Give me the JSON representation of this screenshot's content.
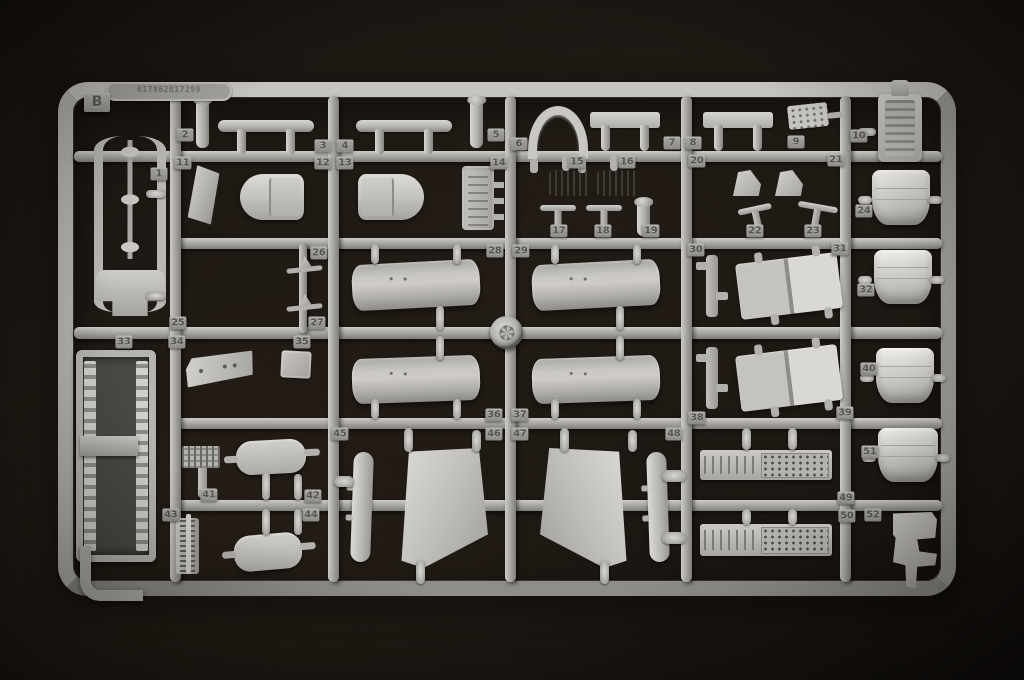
{
  "photo": {
    "subject": "grey injection-molded model kit sprue on black background",
    "background_color": "#1a1511",
    "plastic_color": "#aba9a5",
    "sprue_letter": "B",
    "mold_text": "817862B17299",
    "part_numbers": [
      {
        "n": 1,
        "x": 159,
        "y": 174
      },
      {
        "n": 2,
        "x": 185,
        "y": 135
      },
      {
        "n": 3,
        "x": 323,
        "y": 146
      },
      {
        "n": 4,
        "x": 345,
        "y": 146
      },
      {
        "n": 5,
        "x": 496,
        "y": 135
      },
      {
        "n": 6,
        "x": 519,
        "y": 144
      },
      {
        "n": 7,
        "x": 672,
        "y": 143
      },
      {
        "n": 8,
        "x": 693,
        "y": 143
      },
      {
        "n": 9,
        "x": 796,
        "y": 142
      },
      {
        "n": 10,
        "x": 859,
        "y": 136
      },
      {
        "n": 11,
        "x": 183,
        "y": 163
      },
      {
        "n": 12,
        "x": 323,
        "y": 163
      },
      {
        "n": 13,
        "x": 345,
        "y": 163
      },
      {
        "n": 14,
        "x": 499,
        "y": 163
      },
      {
        "n": 15,
        "x": 577,
        "y": 162
      },
      {
        "n": 16,
        "x": 627,
        "y": 162
      },
      {
        "n": 17,
        "x": 559,
        "y": 231
      },
      {
        "n": 18,
        "x": 603,
        "y": 231
      },
      {
        "n": 19,
        "x": 651,
        "y": 231
      },
      {
        "n": 20,
        "x": 697,
        "y": 161
      },
      {
        "n": 21,
        "x": 836,
        "y": 160
      },
      {
        "n": 22,
        "x": 755,
        "y": 231
      },
      {
        "n": 23,
        "x": 813,
        "y": 231
      },
      {
        "n": 24,
        "x": 864,
        "y": 211
      },
      {
        "n": 25,
        "x": 178,
        "y": 323
      },
      {
        "n": 26,
        "x": 319,
        "y": 253
      },
      {
        "n": 27,
        "x": 317,
        "y": 323
      },
      {
        "n": 28,
        "x": 495,
        "y": 251
      },
      {
        "n": 29,
        "x": 521,
        "y": 251
      },
      {
        "n": 30,
        "x": 696,
        "y": 250
      },
      {
        "n": 31,
        "x": 840,
        "y": 249
      },
      {
        "n": 32,
        "x": 866,
        "y": 290
      },
      {
        "n": 33,
        "x": 124,
        "y": 342
      },
      {
        "n": 34,
        "x": 177,
        "y": 342
      },
      {
        "n": 35,
        "x": 302,
        "y": 342
      },
      {
        "n": 36,
        "x": 494,
        "y": 415
      },
      {
        "n": 37,
        "x": 520,
        "y": 415
      },
      {
        "n": 38,
        "x": 697,
        "y": 418
      },
      {
        "n": 39,
        "x": 845,
        "y": 413
      },
      {
        "n": 40,
        "x": 869,
        "y": 369
      },
      {
        "n": 41,
        "x": 209,
        "y": 495
      },
      {
        "n": 42,
        "x": 313,
        "y": 496
      },
      {
        "n": 43,
        "x": 171,
        "y": 515
      },
      {
        "n": 44,
        "x": 311,
        "y": 515
      },
      {
        "n": 45,
        "x": 340,
        "y": 434
      },
      {
        "n": 46,
        "x": 494,
        "y": 434
      },
      {
        "n": 47,
        "x": 520,
        "y": 434
      },
      {
        "n": 48,
        "x": 674,
        "y": 434
      },
      {
        "n": 49,
        "x": 846,
        "y": 498
      },
      {
        "n": 50,
        "x": 847,
        "y": 516
      },
      {
        "n": 51,
        "x": 870,
        "y": 452
      },
      {
        "n": 52,
        "x": 873,
        "y": 515
      }
    ],
    "runners": [
      {
        "o": "h",
        "x": 74,
        "y": 151,
        "w": 868,
        "h": 11
      },
      {
        "o": "h",
        "x": 170,
        "y": 238,
        "w": 772,
        "h": 11
      },
      {
        "o": "h",
        "x": 74,
        "y": 327,
        "w": 868,
        "h": 12
      },
      {
        "o": "h",
        "x": 170,
        "y": 418,
        "w": 772,
        "h": 11
      },
      {
        "o": "h",
        "x": 170,
        "y": 500,
        "w": 772,
        "h": 11
      },
      {
        "o": "v",
        "x": 170,
        "y": 96,
        "w": 11,
        "h": 486
      },
      {
        "o": "v",
        "x": 328,
        "y": 96,
        "w": 11,
        "h": 486
      },
      {
        "o": "v",
        "x": 505,
        "y": 96,
        "w": 11,
        "h": 486
      },
      {
        "o": "v",
        "x": 681,
        "y": 96,
        "w": 11,
        "h": 486
      },
      {
        "o": "v",
        "x": 840,
        "y": 96,
        "w": 11,
        "h": 486
      },
      {
        "o": "v",
        "x": 299,
        "y": 243,
        "w": 8,
        "h": 90
      }
    ],
    "parts": [
      {
        "k": "cframe",
        "x": 94,
        "y": 136,
        "w": 54,
        "h": 176,
        "n": 1
      },
      {
        "k": "stub",
        "x": 146,
        "y": 190,
        "w": 20,
        "h": 8
      },
      {
        "k": "stub",
        "x": 146,
        "y": 292,
        "w": 20,
        "h": 8
      },
      {
        "k": "tub",
        "x": 76,
        "y": 350,
        "w": 66,
        "h": 198,
        "n": 33
      },
      {
        "k": "shelf",
        "x": 80,
        "y": 436,
        "w": 58,
        "h": 20
      },
      {
        "k": "jhook",
        "x": 80,
        "y": 546,
        "w": 52,
        "h": 44
      },
      {
        "k": "pin",
        "x": 196,
        "y": 98,
        "w": 13,
        "h": 50,
        "n": 2
      },
      {
        "k": "strake",
        "x": 218,
        "y": 120,
        "w": 96,
        "h": 12,
        "n": 3
      },
      {
        "k": "strake",
        "x": 356,
        "y": 120,
        "w": 96,
        "h": 12,
        "n": 4
      },
      {
        "k": "pin",
        "x": 470,
        "y": 98,
        "w": 13,
        "h": 50,
        "n": 5
      },
      {
        "k": "plate",
        "x": 190,
        "y": 166,
        "w": 27,
        "h": 60,
        "r": 6,
        "n": 11
      },
      {
        "k": "pod-l",
        "x": 240,
        "y": 174,
        "w": 64,
        "h": 46,
        "n": 12
      },
      {
        "k": "pod-r",
        "x": 358,
        "y": 174,
        "w": 66,
        "h": 46,
        "n": 13
      },
      {
        "k": "bracket",
        "x": 462,
        "y": 166,
        "w": 32,
        "h": 64,
        "n": 14
      },
      {
        "k": "arch",
        "x": 528,
        "y": 106,
        "w": 42,
        "h": 44,
        "n": 7
      },
      {
        "k": "flatbar",
        "x": 590,
        "y": 112,
        "w": 70,
        "h": 16,
        "n": 8
      },
      {
        "k": "flatbar",
        "x": 703,
        "y": 112,
        "w": 70,
        "h": 16
      },
      {
        "k": "paddle",
        "x": 788,
        "y": 104,
        "w": 40,
        "h": 24,
        "r": -6,
        "n": 9
      },
      {
        "k": "finbar",
        "x": 549,
        "y": 170,
        "w": 42,
        "h": 26,
        "n": 15
      },
      {
        "k": "finbar",
        "x": 597,
        "y": 170,
        "w": 42,
        "h": 26,
        "n": 16
      },
      {
        "k": "tpin",
        "x": 540,
        "y": 205,
        "w": 36,
        "h": 30,
        "n": 17
      },
      {
        "k": "tpin",
        "x": 586,
        "y": 205,
        "w": 36,
        "h": 30,
        "n": 18
      },
      {
        "k": "pin",
        "x": 637,
        "y": 200,
        "w": 13,
        "h": 36,
        "n": 19
      },
      {
        "k": "wedge",
        "x": 733,
        "y": 170,
        "w": 28,
        "h": 26,
        "n": 20
      },
      {
        "k": "wedge",
        "x": 775,
        "y": 170,
        "w": 28,
        "h": 26,
        "n": 21
      },
      {
        "k": "tpin",
        "x": 740,
        "y": 206,
        "w": 34,
        "h": 28,
        "r": -12,
        "n": 22
      },
      {
        "k": "tpin",
        "x": 796,
        "y": 204,
        "w": 40,
        "h": 28,
        "r": 10,
        "n": 23
      },
      {
        "k": "ant",
        "x": 286,
        "y": 256,
        "w": 36,
        "h": 18,
        "r": -6,
        "n": 26
      },
      {
        "k": "ant",
        "x": 286,
        "y": 294,
        "w": 36,
        "h": 18,
        "r": -6,
        "n": 27
      },
      {
        "k": "tank",
        "x": 352,
        "y": 262,
        "w": 128,
        "h": 46,
        "r": -3,
        "n": 28
      },
      {
        "k": "tank",
        "x": 532,
        "y": 262,
        "w": 128,
        "h": 46,
        "r": -3,
        "n": 29
      },
      {
        "k": "wheel",
        "x": 490,
        "y": 316,
        "w": 33,
        "h": 33
      },
      {
        "k": "tank",
        "x": 352,
        "y": 357,
        "w": 128,
        "h": 45,
        "r": -2,
        "n": 36
      },
      {
        "k": "tank",
        "x": 532,
        "y": 357,
        "w": 128,
        "h": 45,
        "r": -2,
        "n": 37
      },
      {
        "k": "vstub",
        "x": 371,
        "y": 244,
        "w": 8,
        "h": 20
      },
      {
        "k": "vstub",
        "x": 453,
        "y": 244,
        "w": 8,
        "h": 20
      },
      {
        "k": "vstub",
        "x": 551,
        "y": 244,
        "w": 8,
        "h": 20
      },
      {
        "k": "vstub",
        "x": 633,
        "y": 244,
        "w": 8,
        "h": 20
      },
      {
        "k": "vstub",
        "x": 436,
        "y": 306,
        "w": 8,
        "h": 24
      },
      {
        "k": "vstub",
        "x": 616,
        "y": 306,
        "w": 8,
        "h": 24
      },
      {
        "k": "vstub",
        "x": 436,
        "y": 336,
        "w": 8,
        "h": 24
      },
      {
        "k": "vstub",
        "x": 616,
        "y": 336,
        "w": 8,
        "h": 24
      },
      {
        "k": "vstub",
        "x": 371,
        "y": 399,
        "w": 8,
        "h": 20
      },
      {
        "k": "vstub",
        "x": 453,
        "y": 399,
        "w": 8,
        "h": 20
      },
      {
        "k": "vstub",
        "x": 551,
        "y": 399,
        "w": 8,
        "h": 20
      },
      {
        "k": "vstub",
        "x": 633,
        "y": 399,
        "w": 8,
        "h": 20
      },
      {
        "k": "clip",
        "x": 706,
        "y": 255,
        "w": 12,
        "h": 62,
        "n": 30
      },
      {
        "k": "ramp",
        "x": 738,
        "y": 258,
        "w": 102,
        "h": 56,
        "r": -7,
        "n": 31
      },
      {
        "k": "clip",
        "x": 706,
        "y": 347,
        "w": 12,
        "h": 62,
        "n": 38
      },
      {
        "k": "ramp",
        "x": 738,
        "y": 350,
        "w": 102,
        "h": 56,
        "r": -7,
        "n": 39
      },
      {
        "k": "console",
        "x": 186,
        "y": 354,
        "w": 68,
        "h": 30,
        "r": -6,
        "n": 34
      },
      {
        "k": "box",
        "x": 281,
        "y": 351,
        "w": 30,
        "h": 27,
        "r": 3,
        "n": 35
      },
      {
        "k": "gridpedal",
        "x": 182,
        "y": 446,
        "w": 38,
        "h": 52,
        "n": 41
      },
      {
        "k": "podr",
        "x": 236,
        "y": 440,
        "w": 70,
        "h": 34,
        "r": -3,
        "n": 42
      },
      {
        "k": "vstub",
        "x": 262,
        "y": 472,
        "w": 8,
        "h": 28
      },
      {
        "k": "vstub",
        "x": 294,
        "y": 474,
        "w": 8,
        "h": 26
      },
      {
        "k": "rail",
        "x": 176,
        "y": 518,
        "w": 23,
        "h": 56,
        "n": 43
      },
      {
        "k": "podr",
        "x": 234,
        "y": 534,
        "w": 68,
        "h": 36,
        "r": -5,
        "n": 44
      },
      {
        "k": "vstub",
        "x": 262,
        "y": 509,
        "w": 8,
        "h": 26
      },
      {
        "k": "vstub",
        "x": 294,
        "y": 509,
        "w": 8,
        "h": 26
      },
      {
        "k": "blade",
        "x": 352,
        "y": 452,
        "w": 20,
        "h": 110,
        "r": 2,
        "n": 45
      },
      {
        "k": "stub",
        "x": 334,
        "y": 476,
        "w": 20,
        "h": 11
      },
      {
        "k": "trapl",
        "x": 396,
        "y": 448,
        "w": 92,
        "h": 120,
        "n": 46
      },
      {
        "k": "trapr",
        "x": 540,
        "y": 448,
        "w": 92,
        "h": 120,
        "n": 47
      },
      {
        "k": "vstub",
        "x": 404,
        "y": 428,
        "w": 9,
        "h": 24
      },
      {
        "k": "vstub",
        "x": 472,
        "y": 430,
        "w": 9,
        "h": 22
      },
      {
        "k": "vstub",
        "x": 560,
        "y": 428,
        "w": 9,
        "h": 24
      },
      {
        "k": "vstub",
        "x": 628,
        "y": 430,
        "w": 9,
        "h": 22
      },
      {
        "k": "vstub",
        "x": 416,
        "y": 560,
        "w": 9,
        "h": 24
      },
      {
        "k": "vstub",
        "x": 600,
        "y": 560,
        "w": 9,
        "h": 24
      },
      {
        "k": "blade",
        "x": 648,
        "y": 452,
        "w": 20,
        "h": 110,
        "r": -2,
        "n": 48
      },
      {
        "k": "stub",
        "x": 662,
        "y": 470,
        "w": 24,
        "h": 12
      },
      {
        "k": "stub",
        "x": 662,
        "y": 532,
        "w": 24,
        "h": 12
      },
      {
        "k": "walkway",
        "x": 700,
        "y": 450,
        "w": 132,
        "h": 30,
        "n": 49
      },
      {
        "k": "walkway",
        "x": 700,
        "y": 524,
        "w": 132,
        "h": 32,
        "n": 50
      },
      {
        "k": "vstub",
        "x": 742,
        "y": 428,
        "w": 9,
        "h": 22
      },
      {
        "k": "vstub",
        "x": 788,
        "y": 428,
        "w": 9,
        "h": 22
      },
      {
        "k": "vstub",
        "x": 742,
        "y": 509,
        "w": 9,
        "h": 16
      },
      {
        "k": "vstub",
        "x": 788,
        "y": 509,
        "w": 9,
        "h": 16
      },
      {
        "k": "seat",
        "x": 878,
        "y": 94,
        "w": 44,
        "h": 68,
        "n": 10
      },
      {
        "k": "stub",
        "x": 858,
        "y": 128,
        "w": 18,
        "h": 8
      },
      {
        "k": "cowl",
        "x": 872,
        "y": 170,
        "w": 58,
        "h": 55,
        "n": 24
      },
      {
        "k": "stub",
        "x": 858,
        "y": 196,
        "w": 14,
        "h": 8
      },
      {
        "k": "stub",
        "x": 928,
        "y": 196,
        "w": 14,
        "h": 8
      },
      {
        "k": "cowl",
        "x": 874,
        "y": 250,
        "w": 58,
        "h": 54,
        "n": 32
      },
      {
        "k": "stub",
        "x": 858,
        "y": 276,
        "w": 14,
        "h": 8
      },
      {
        "k": "stub",
        "x": 930,
        "y": 276,
        "w": 14,
        "h": 8
      },
      {
        "k": "cowl",
        "x": 876,
        "y": 348,
        "w": 58,
        "h": 55,
        "n": 40
      },
      {
        "k": "stub",
        "x": 860,
        "y": 374,
        "w": 14,
        "h": 8
      },
      {
        "k": "stub",
        "x": 932,
        "y": 374,
        "w": 14,
        "h": 8
      },
      {
        "k": "cowl",
        "x": 878,
        "y": 428,
        "w": 60,
        "h": 54,
        "n": 51
      },
      {
        "k": "stub",
        "x": 862,
        "y": 454,
        "w": 14,
        "h": 8
      },
      {
        "k": "stub",
        "x": 936,
        "y": 454,
        "w": 14,
        "h": 8
      },
      {
        "k": "bracket52",
        "x": 893,
        "y": 512,
        "w": 44,
        "h": 76,
        "n": 52
      }
    ]
  }
}
